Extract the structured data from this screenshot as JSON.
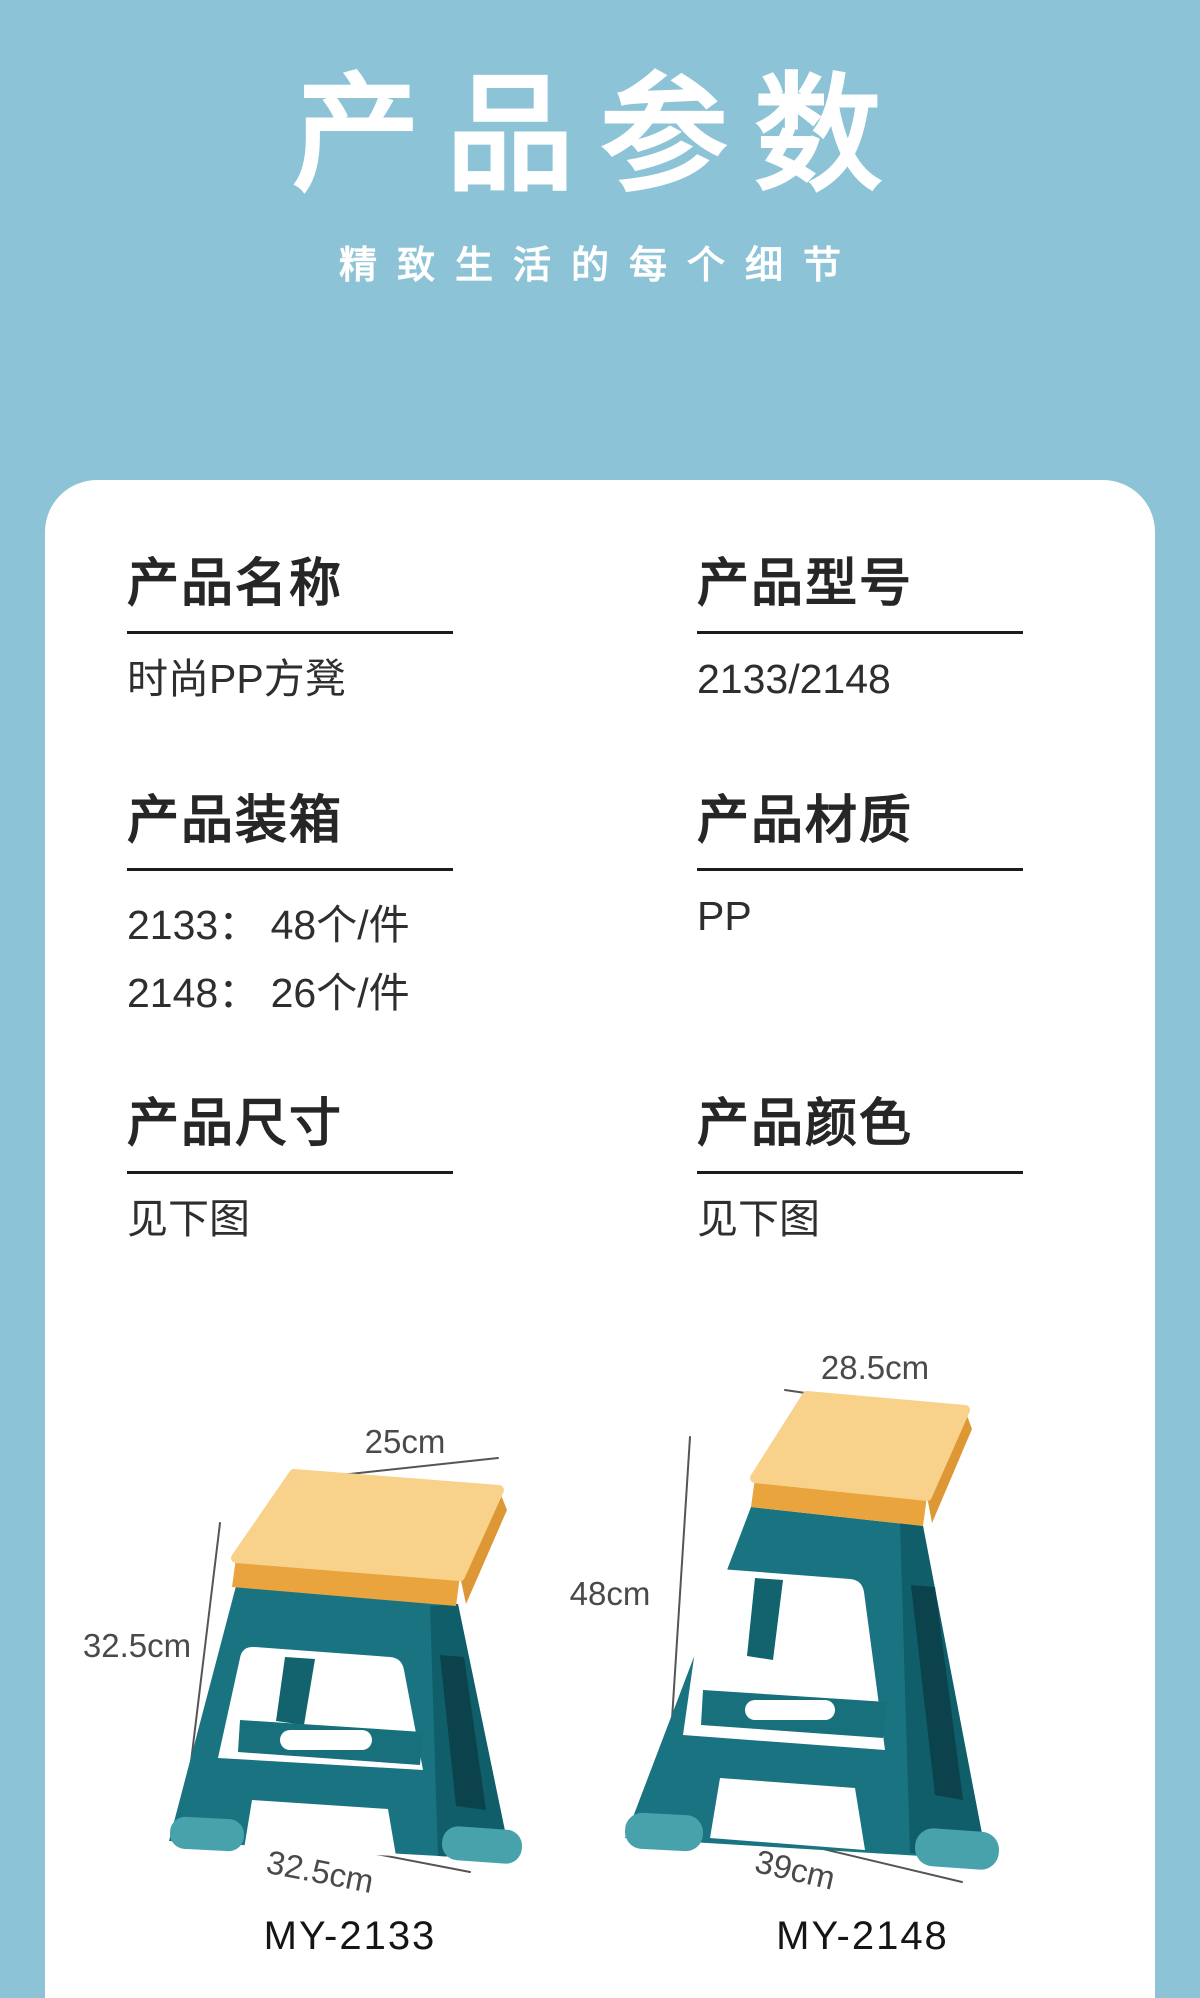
{
  "header": {
    "title": "产品参数",
    "subtitle": "精致生活的每个细节"
  },
  "specs": {
    "name": {
      "heading": "产品名称",
      "value": "时尚PP方凳"
    },
    "model": {
      "heading": "产品型号",
      "value": "2133/2148"
    },
    "packing": {
      "heading": "产品装箱",
      "lines": [
        "2133： 48个/件",
        "2148： 26个/件"
      ]
    },
    "material": {
      "heading": "产品材质",
      "value": "PP"
    },
    "size": {
      "heading": "产品尺寸",
      "value": "见下图"
    },
    "color": {
      "heading": "产品颜色",
      "value": "见下图"
    }
  },
  "stools": [
    {
      "model_label": "MY-2133",
      "top_width": "25cm",
      "height": "32.5cm",
      "bottom_width": "32.5cm"
    },
    {
      "model_label": "MY-2148",
      "top_width": "28.5cm",
      "height": "48cm",
      "bottom_width": "39cm"
    }
  ],
  "colors": {
    "background": "#8cc3d6",
    "card": "#ffffff",
    "heading_text": "#262626",
    "value_text": "#2e2e2e",
    "dimension_text": "#4a4a4a",
    "stool_seat_top": "#f8d28b",
    "stool_seat_edge": "#e9a43e",
    "stool_body": "#1a7380",
    "stool_body_side": "#0f5e69",
    "stool_foot": "#47a2ac"
  }
}
